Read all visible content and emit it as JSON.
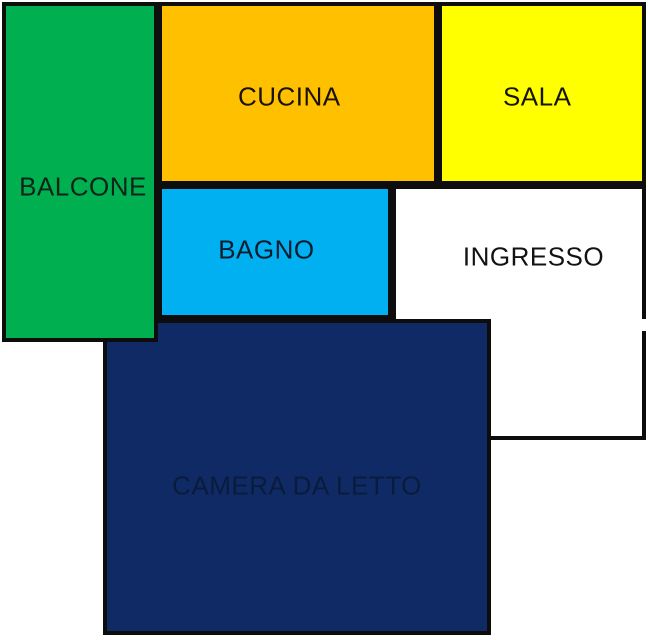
{
  "figure": {
    "type": "apartment-floor-plan",
    "background": "#FFFFFF",
    "wall_color": "#0D0D0D"
  },
  "rooms": [
    {
      "id": "balcone",
      "label": "BALCONE",
      "fill": "#00B050",
      "label_color": "#0E2418"
    },
    {
      "id": "cucina",
      "label": "CUCINA",
      "fill": "#FFC000",
      "label_color": "#1A1208"
    },
    {
      "id": "sala",
      "label": "SALA",
      "fill": "#FFFF00",
      "label_color": "#141405"
    },
    {
      "id": "bagno",
      "label": "BAGNO",
      "fill": "#00B0F0",
      "label_color": "#0A1B2E"
    },
    {
      "id": "ingresso",
      "label": "INGRESSO",
      "fill": "#FFFFFF",
      "label_color": "#121212"
    },
    {
      "id": "camera",
      "label": "CAMERA DA LETTO",
      "fill": "#102A66",
      "label_color": "#0A1C3C"
    }
  ],
  "features": {
    "door_opening_right_wall_of_ingresso": true
  }
}
